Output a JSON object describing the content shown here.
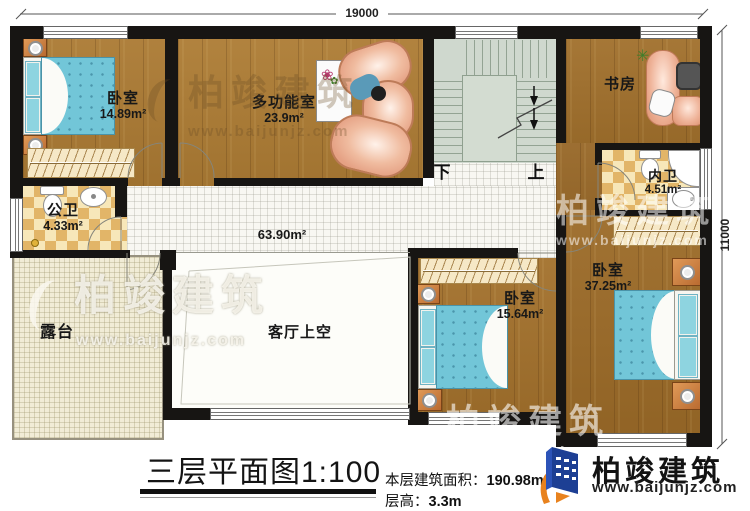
{
  "dimensions": {
    "top": "19000",
    "right": "11000"
  },
  "rooms": {
    "bedroom1": {
      "label": "卧室",
      "area": "14.89m²"
    },
    "multifunction": {
      "label": "多功能室",
      "area": "23.9m²"
    },
    "public_bath": {
      "label": "公卫",
      "area": "4.33m²"
    },
    "study": {
      "label": "书房"
    },
    "inner_bath": {
      "label": "内卫",
      "area": "4.51m²"
    },
    "bedroom_master": {
      "label": "卧室",
      "area": "37.25m²"
    },
    "bedroom_mid": {
      "label": "卧室",
      "area": "15.64m²"
    },
    "terrace": {
      "label": "露台"
    },
    "living_void": {
      "label": "客厅上空"
    },
    "corridor": {
      "area": "63.90m²"
    }
  },
  "stairs": {
    "down_label": "下",
    "up_label": "上"
  },
  "title_block": {
    "title": "三层平面图1:100",
    "area_label": "本层建筑面积：",
    "area_value": "190.98m²",
    "height_label": "层高：",
    "height_value": "3.3m"
  },
  "brand": {
    "name": "柏竣建筑",
    "website": "www.baijunjz.com"
  },
  "watermark": {
    "name": "柏竣建筑",
    "website": "www.baijunjz.com"
  },
  "colors": {
    "wall": "#171513",
    "wood": "#a9762f",
    "bed": "#72c6d8",
    "bath_tile": "#e2b568",
    "stair": "#cfd8ce",
    "terrace": "#f1ecd6",
    "brand_blue": "#1d3f94",
    "brand_orange": "#e8821e"
  }
}
